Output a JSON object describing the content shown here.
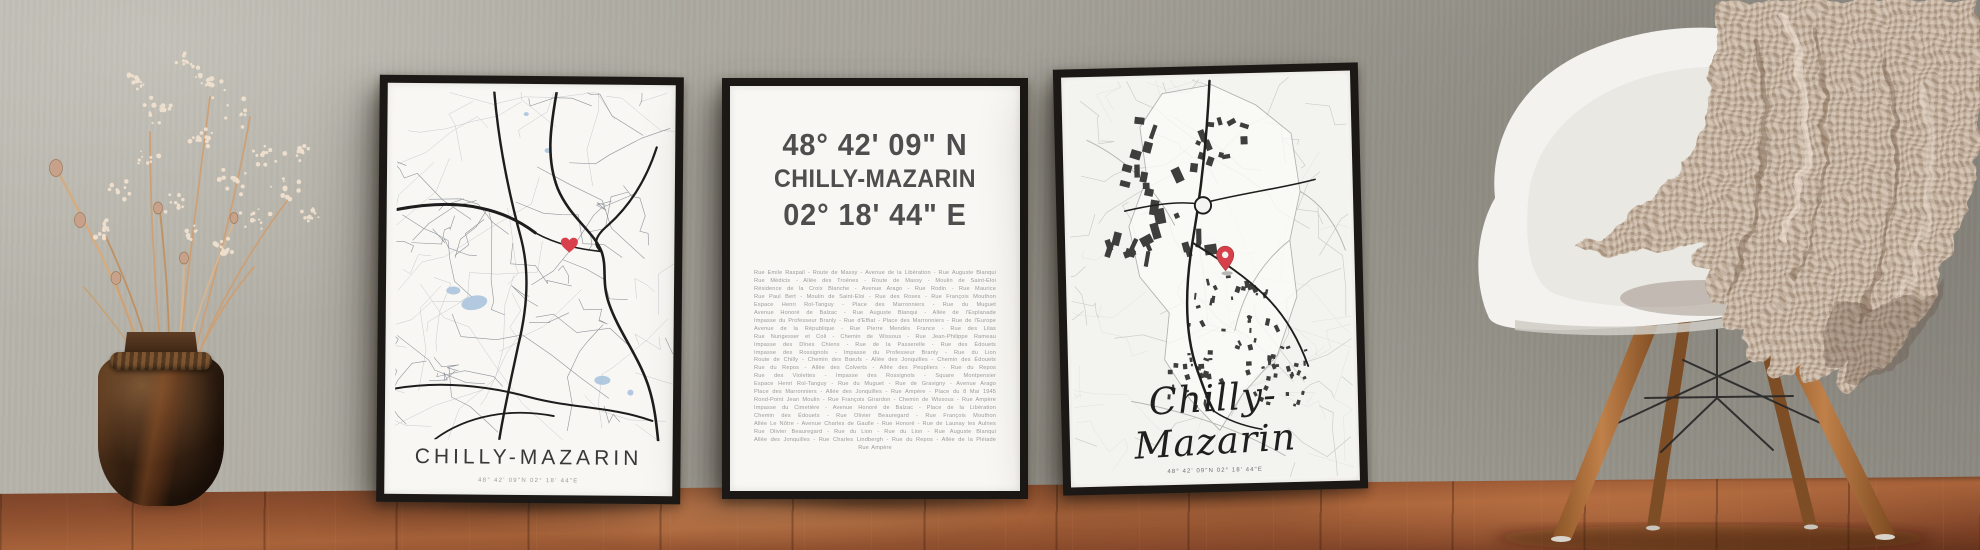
{
  "colors": {
    "wall_gray": "#aaa79e",
    "floor_wood_brown": "#8c4e2e",
    "frame_black": "#1b1815",
    "paper_white": "#f8f7f3",
    "map_water_blue": "#aac4de",
    "marker_red": "#d8414b",
    "title_dark": "#3c3c3c",
    "coord_text_gray": "#4e4e4e",
    "street_text_gray": "#9c9c9c",
    "chair_shell_white": "#f3f2ee",
    "chair_leg_wood": "#a96f3e",
    "blanket_beige": "#c3b1a1"
  },
  "markers": {
    "left_poster_marker": "heart",
    "right_poster_marker": "map-pin"
  },
  "posters": {
    "left": {
      "title": "CHILLY-MAZARIN",
      "coordinates": "48° 42' 09\"N 02° 18' 44\"E"
    },
    "middle": {
      "latitude": "48° 42' 09\" N",
      "city": "CHILLY-MAZARIN",
      "longitude": "02° 18' 44\" E",
      "streets": [
        "Rue Emile Raspail - Route de Massy - Avenue de la Libération - Rue Auguste Blanqui",
        "Rue Médicis - Allée des Troènes - Route de Massy - Moulin de Saint-Eloi",
        "Résidence de la Croix Blanche - Avenue Arago - Rue Rodin - Rue Maurice",
        "Rue Paul Bert - Moulin de Saint-Eloi - Rue des Roses - Rue François Mouthon",
        "Espace Henri Rol-Tanguy - Place des Marronniers - Rue du Muguet",
        "Avenue Honoré de Balzac - Rue Auguste Blanqui - Allée de l'Esplanade",
        "Impasse du Professeur Branly - Rue d'Effiat - Place des Marronniers - Rue de l'Europe",
        "Avenue de la République - Rue Pierre Mendès France - Rue des Lilas",
        "Rue Nungesser et Coli - Chemin de Wissous - Rue Jean-Philippe Rameau",
        "Impasse des Dînes Chiens - Rue de la Passerelle - Rue des Édouets",
        "Impasse des Rossignols - Impasse du Professeur Branly - Rue du Lion",
        "Route de Chilly - Chemin des Bœufs - Allée des Jonquilles - Chemin des Édouets",
        "Rue du Repos - Allée des Colverts - Allée des Peupliers - Rue du Repos",
        "Rue des Violettes - Impasse des Rossignols - Square Montpensier",
        "Espace Henri Rol-Tanguy - Rue du Muguet - Rue de Gravigny - Avenue Arago",
        "Place des Marronniers - Allée des Jonquilles - Rue Ampère - Place du 8 Mai 1945",
        "Rond-Point Jean Moulin - Rue François Girardon - Chemin de Wissous - Rue Ampère",
        "Impasse du Cimetière - Avenue Honoré de Balzac - Place de la Libération",
        "Chemin des Édouets - Rue Olivier Beauregard - Rue François Mouthon",
        "Allée Le Nôtre - Avenue Charles de Gaulle - Rue Honoré - Rue de Launay les Aulnes",
        "Rue Olivier Beauregard - Rue du Lion - Rue du Lion - Rue Auguste Blanqui",
        "Allée des Jonquilles - Rue Charles Lindbergh - Rue du Repos - Allée de la Pléiade",
        "Rue Ampère"
      ]
    },
    "right": {
      "title": "Chilly-Mazarin",
      "coordinates": "48° 42' 09\"N 02° 18' 44\"E"
    }
  }
}
